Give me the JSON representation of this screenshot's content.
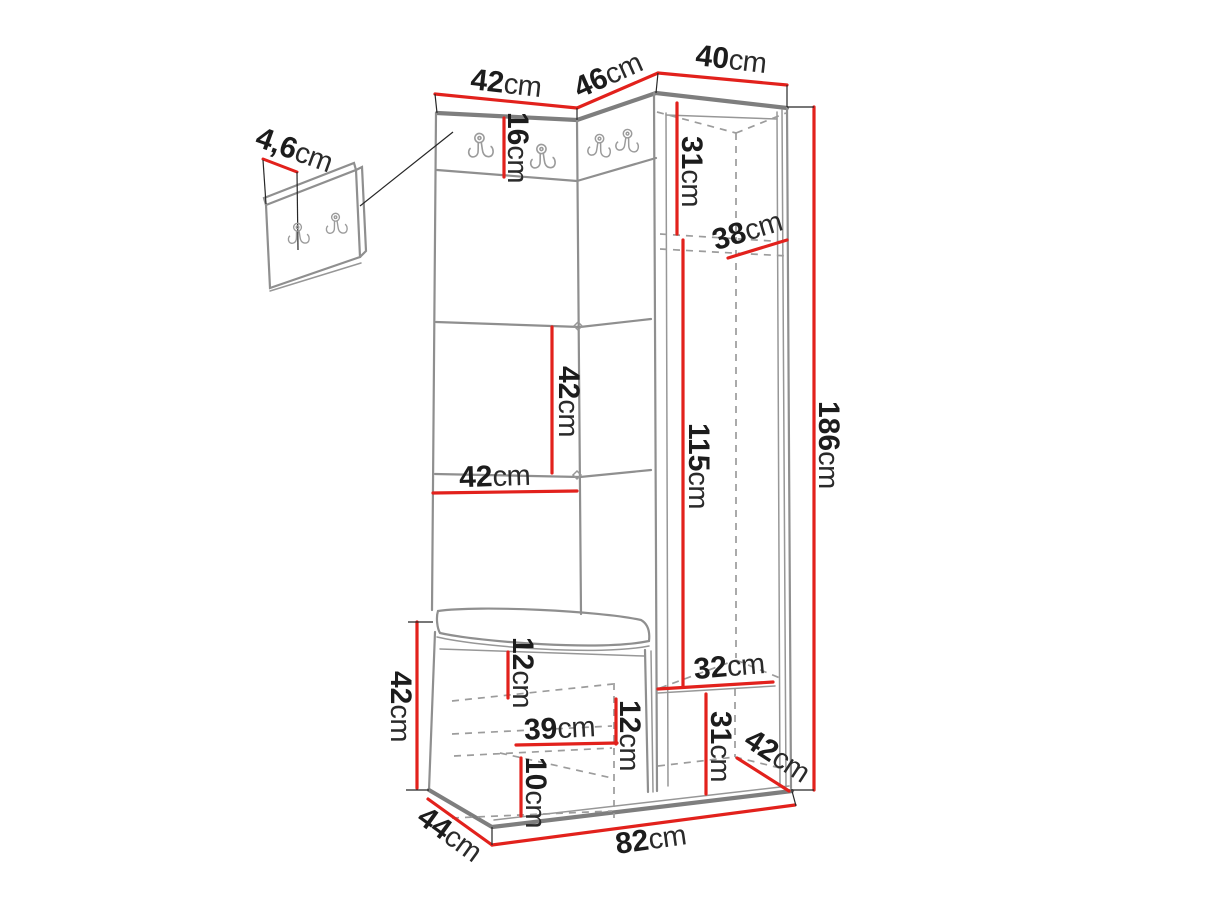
{
  "diagram": {
    "type": "furniture-dimension-diagram",
    "subject": "hallway furniture set: wall hook panel, upholstered coat-rack panels, shoe bench and tall open wardrobe with dimension lines",
    "unit": "cm",
    "colors": {
      "dimension_line": "#e2211c",
      "outline": "#8a8a8a",
      "hidden_line": "#9c9c9c",
      "label_text": "#1c1c1c",
      "background": "#ffffff"
    },
    "icons": [
      {
        "name": "coat-hook-icon",
        "meaning": "double metal coat hook"
      }
    ],
    "dimensions": [
      {
        "name": "top-left-panel-width",
        "value": "42",
        "unit": "cm"
      },
      {
        "name": "corner-panel-width",
        "value": "46",
        "unit": "cm"
      },
      {
        "name": "wardrobe-width",
        "value": "40",
        "unit": "cm"
      },
      {
        "name": "hook-panel-thickness",
        "value": "4,6",
        "unit": "cm"
      },
      {
        "name": "hook-rail-height",
        "value": "16",
        "unit": "cm"
      },
      {
        "name": "wardrobe-top-section-height",
        "value": "31",
        "unit": "cm"
      },
      {
        "name": "wardrobe-depth",
        "value": "38",
        "unit": "cm"
      },
      {
        "name": "total-height",
        "value": "186",
        "unit": "cm"
      },
      {
        "name": "cushion-panel-height",
        "value": "42",
        "unit": "cm"
      },
      {
        "name": "cushion-panel-width",
        "value": "42",
        "unit": "cm"
      },
      {
        "name": "hanging-section-height",
        "value": "115",
        "unit": "cm"
      },
      {
        "name": "wardrobe-interior-width",
        "value": "32",
        "unit": "cm"
      },
      {
        "name": "bench-top-clearance",
        "value": "12",
        "unit": "cm"
      },
      {
        "name": "bench-shelf-width",
        "value": "39",
        "unit": "cm"
      },
      {
        "name": "bench-shelf-spacing",
        "value": "12",
        "unit": "cm"
      },
      {
        "name": "bench-bottom-shelf-height",
        "value": "10",
        "unit": "cm"
      },
      {
        "name": "wardrobe-bottom-section-height",
        "value": "31",
        "unit": "cm"
      },
      {
        "name": "wardrobe-bottom-depth",
        "value": "42",
        "unit": "cm"
      },
      {
        "name": "bench-height",
        "value": "42",
        "unit": "cm"
      },
      {
        "name": "bench-depth",
        "value": "44",
        "unit": "cm"
      },
      {
        "name": "unit-base-width",
        "value": "82",
        "unit": "cm"
      }
    ]
  }
}
